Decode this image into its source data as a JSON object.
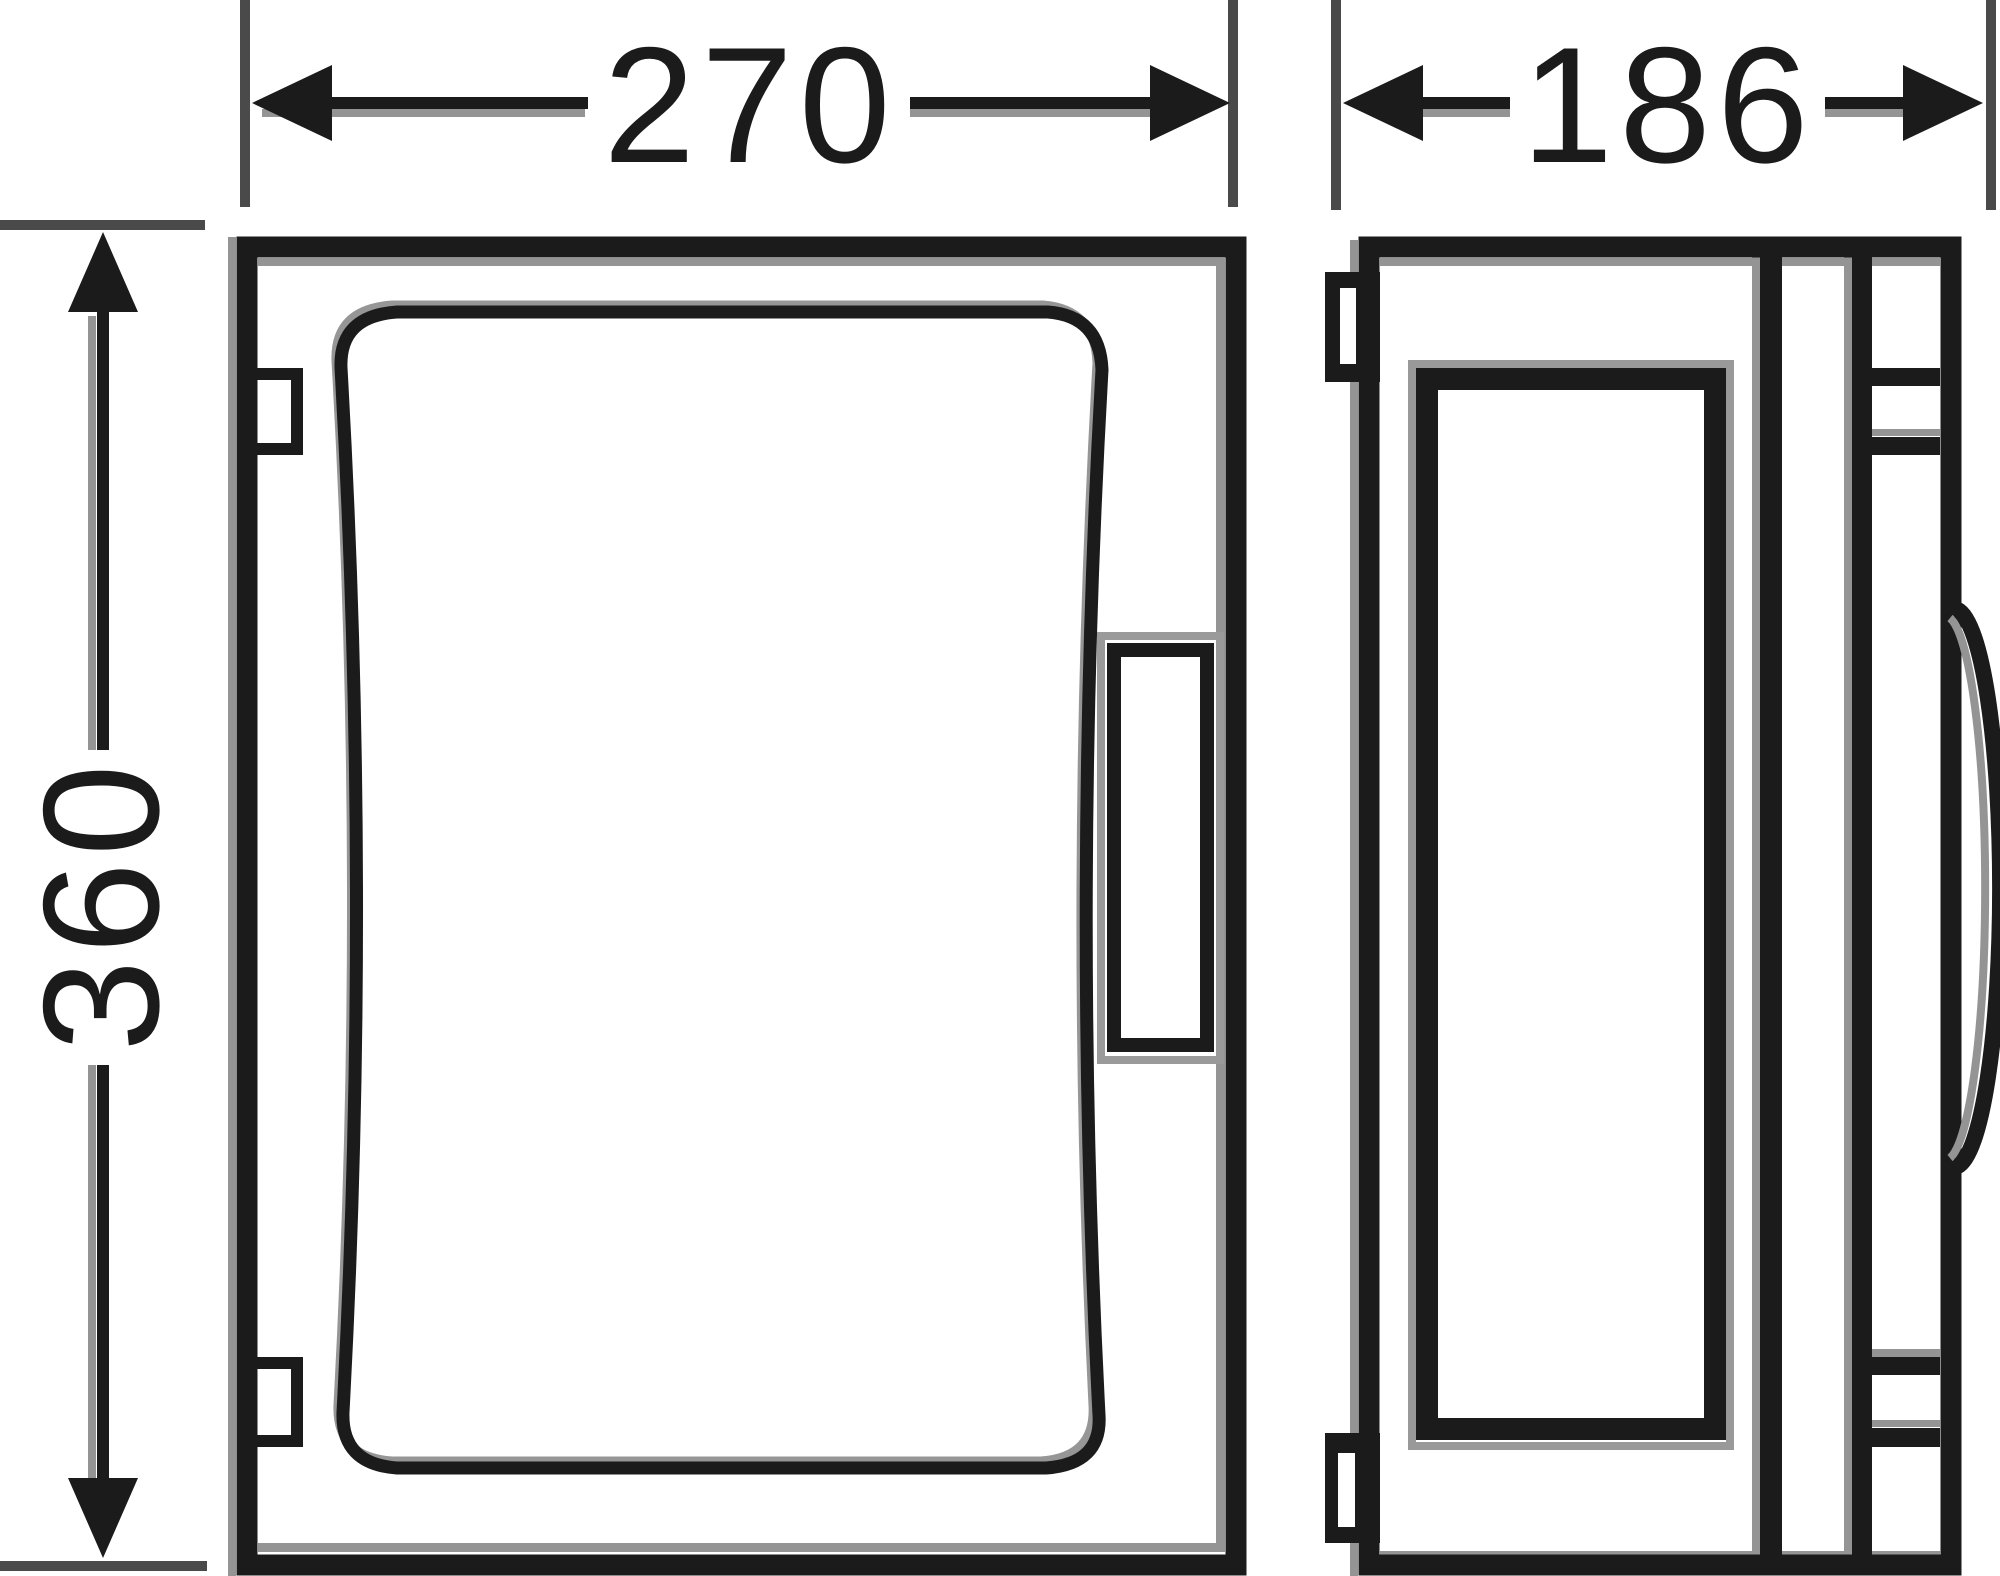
{
  "drawing": {
    "kind": "enclosure dimension drawing, front and side view",
    "dimensions": {
      "front_width": {
        "value": "270",
        "orientation": "horizontal"
      },
      "side_depth": {
        "value": "186",
        "orientation": "horizontal"
      },
      "front_height": {
        "value": "360",
        "orientation": "vertical"
      }
    },
    "colors": {
      "line": "#1b1b1b",
      "ghost": "#949494",
      "extension_line": "#4a4a4a",
      "background": "#ffffff"
    }
  }
}
